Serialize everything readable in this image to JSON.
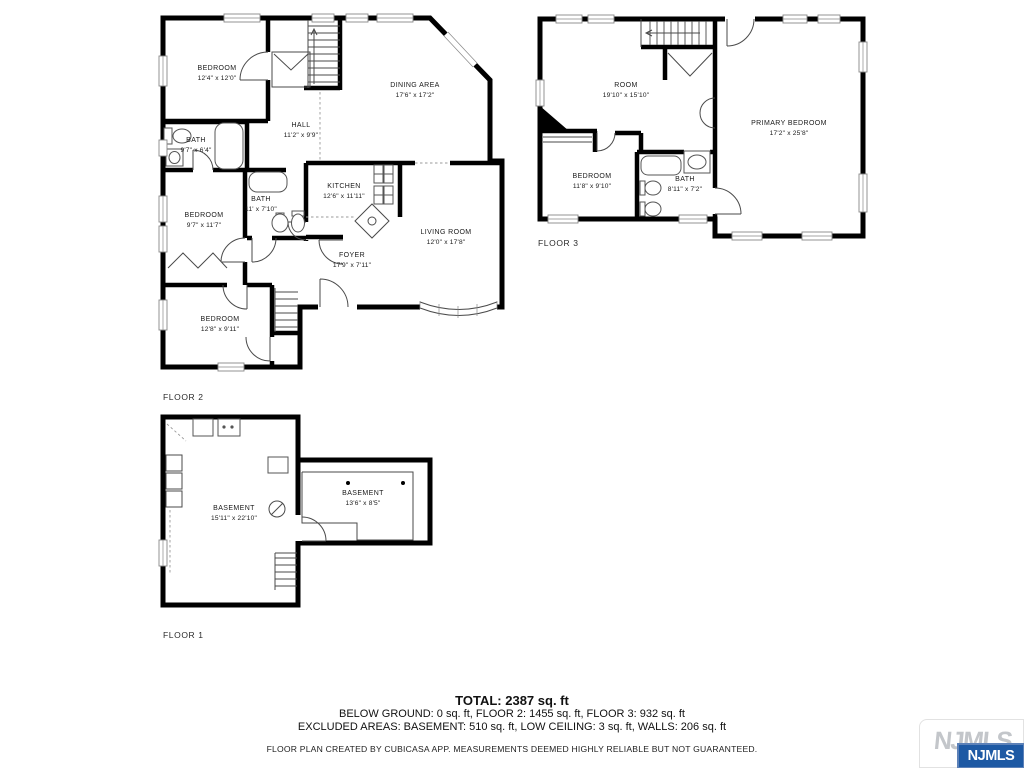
{
  "floors": [
    {
      "label": "FLOOR 2",
      "rooms": [
        {
          "name": "BEDROOM",
          "dims": "12'4\" x 12'0\""
        },
        {
          "name": "DINING AREA",
          "dims": "17'6\" x 17'2\""
        },
        {
          "name": "HALL",
          "dims": "11'2\" x 9'9\""
        },
        {
          "name": "BATH",
          "dims": "9'7\" x 6'4\""
        },
        {
          "name": "BEDROOM",
          "dims": "9'7\" x 11'7\""
        },
        {
          "name": "BATH",
          "dims": "11' x 7'10\""
        },
        {
          "name": "KITCHEN",
          "dims": "12'6\" x 11'11\""
        },
        {
          "name": "LIVING ROOM",
          "dims": "12'0\" x 17'8\""
        },
        {
          "name": "FOYER",
          "dims": "17'9\" x 7'11\""
        },
        {
          "name": "BEDROOM",
          "dims": "12'8\" x 9'11\""
        }
      ]
    },
    {
      "label": "FLOOR 3",
      "rooms": [
        {
          "name": "ROOM",
          "dims": "19'10\" x 15'10\""
        },
        {
          "name": "PRIMARY BEDROOM",
          "dims": "17'2\" x 25'8\""
        },
        {
          "name": "BEDROOM",
          "dims": "11'8\" x 9'10\""
        },
        {
          "name": "BATH",
          "dims": "8'11\" x 7'2\""
        }
      ]
    },
    {
      "label": "FLOOR 1",
      "rooms": [
        {
          "name": "BASEMENT",
          "dims": "15'11\" x 22'10\""
        },
        {
          "name": "BASEMENT",
          "dims": "13'6\" x 8'5\""
        }
      ]
    }
  ],
  "summary": {
    "total": "TOTAL: 2387 sq. ft",
    "floors_line": "BELOW GROUND: 0 sq. ft, FLOOR 2: 1455 sq. ft, FLOOR 3: 932 sq. ft",
    "excluded_line": "EXCLUDED AREAS: BASEMENT: 510 sq. ft, LOW CEILING: 3 sq. ft, WALLS: 206 sq. ft",
    "disclaimer": "FLOOR PLAN CREATED BY CUBICASA APP. MEASUREMENTS DEEMED HIGHLY RELIABLE BUT NOT GUARANTEED."
  },
  "branding": {
    "watermark": "NJMLS",
    "badge": "NJMLS",
    "badge_color": "#1d59a4",
    "watermark_color": "#c3c6ca"
  }
}
